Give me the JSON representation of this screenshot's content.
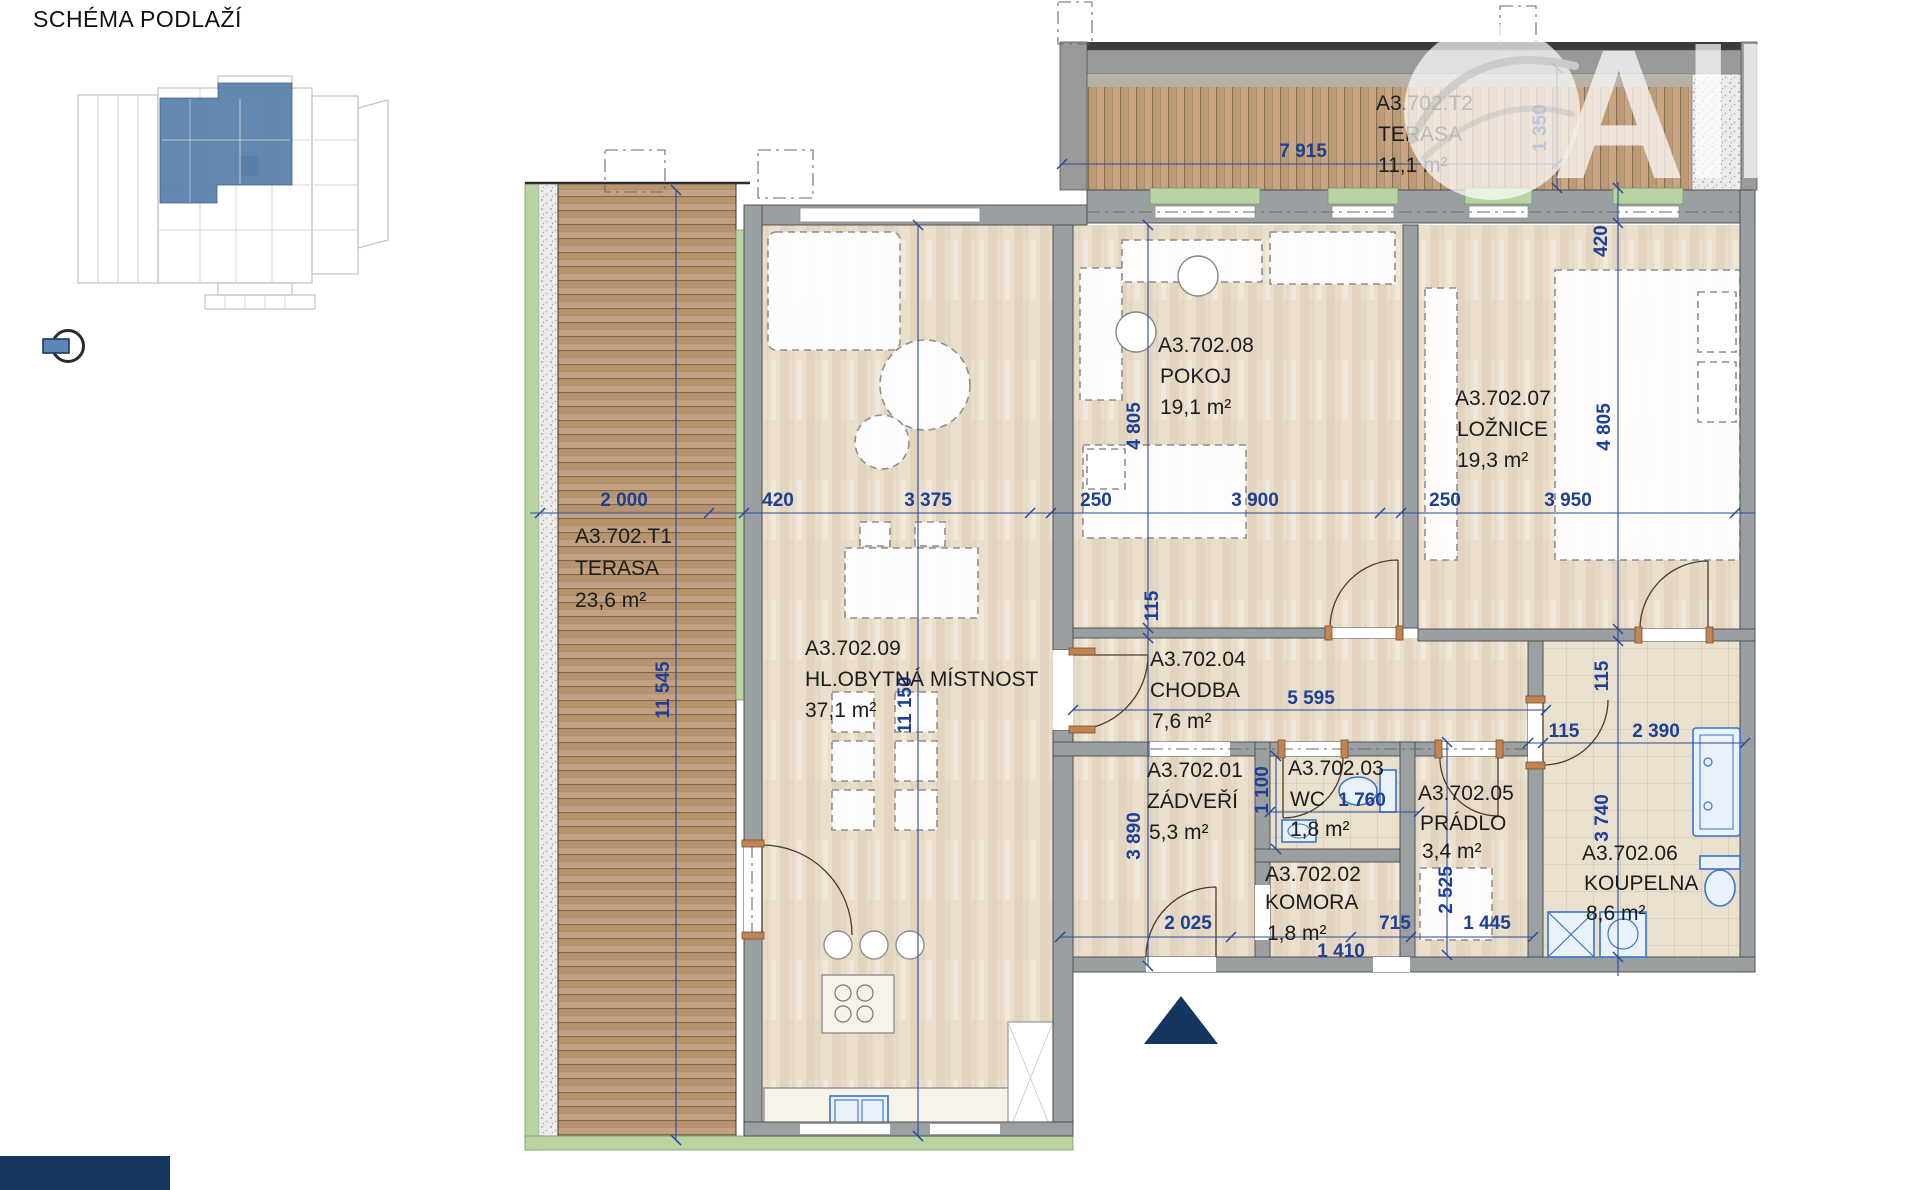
{
  "header": {
    "title": "SCHÉMA PODLAŽÍ"
  },
  "watermark": {
    "text": "Allri"
  },
  "rooms": [
    {
      "code": "A3.702.T1",
      "name": "TERASA",
      "area": "23,6 m²"
    },
    {
      "code": "A3.702.T2",
      "name": "TERASA",
      "area": "11,1 m²"
    },
    {
      "code": "A3.702.01",
      "name": "ZÁDVEŘÍ",
      "area": "5,3 m²"
    },
    {
      "code": "A3.702.02",
      "name": "KOMORA",
      "area": "1,8 m²"
    },
    {
      "code": "A3.702.03",
      "name": "WC",
      "area": "1,8 m²"
    },
    {
      "code": "A3.702.04",
      "name": "CHODBA",
      "area": "7,6 m²"
    },
    {
      "code": "A3.702.05",
      "name": "PRÁDLO",
      "area": "3,4 m²"
    },
    {
      "code": "A3.702.06",
      "name": "KOUPELNA",
      "area": "8,6 m²"
    },
    {
      "code": "A3.702.07",
      "name": "LOŽNICE",
      "area": "19,3 m²"
    },
    {
      "code": "A3.702.08",
      "name": "POKOJ",
      "area": "19,1 m²"
    },
    {
      "code": "A3.702.09",
      "name": "HL.OBYTNÁ MÍSTNOST",
      "area": "37,1 m²"
    }
  ],
  "dims": {
    "d7915": "7 915",
    "d1350": "1 350",
    "d420top": "420",
    "d2000": "2 000",
    "d420": "420",
    "d3375": "3 375",
    "d250a": "250",
    "d3900": "3 900",
    "d250b": "250",
    "d3950": "3 950",
    "d4805a": "4 805",
    "d4805b": "4 805",
    "d11545": "11 545",
    "d11150": "11 150",
    "d115a": "115",
    "d115b": "115",
    "d115c": "115",
    "d5595": "5 595",
    "d2390": "2 390",
    "d3740": "3 740",
    "d1100": "1 100",
    "d1760": "1 760",
    "d3890": "3 890",
    "d2025": "2 025",
    "d1410": "1 410",
    "d715": "715",
    "d2525": "2 525",
    "d1445": "1 445"
  },
  "colors": {
    "dimension_blue": "#1e3f96",
    "highlight_blue": "#567ea8",
    "navy": "#17375e",
    "wall_gray": "#9aa0a2",
    "sill_green": "#b9d3a3",
    "fixture_blue": "#3b74c9"
  }
}
